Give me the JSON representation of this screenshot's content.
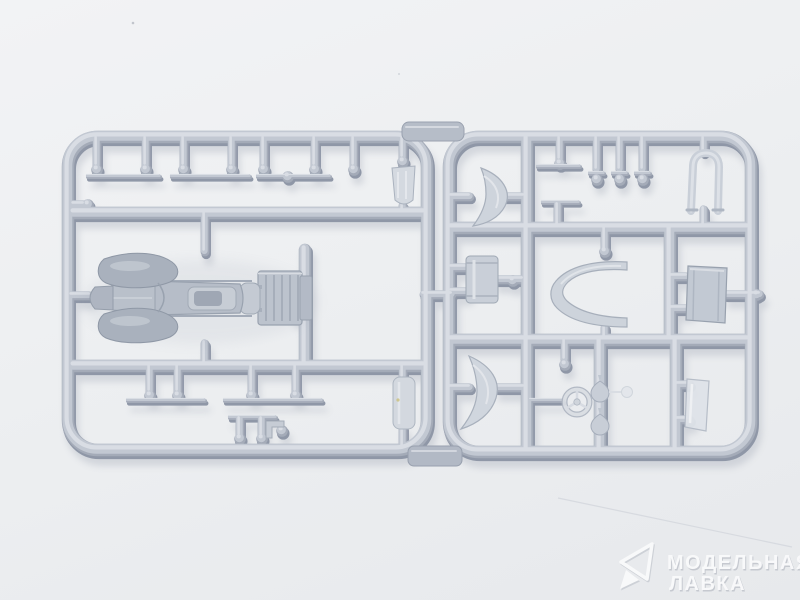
{
  "scene": {
    "subject": "grey injection-molded model kit sprue with vintage car parts on white surface",
    "background_color": "#eceef1",
    "plastic_color": "#a4abb8",
    "plastic_highlight": "#dbdfe6",
    "plastic_shadow": "#8e96a6",
    "part_names": [
      "car-body",
      "front-fender-crescent",
      "rear-fender-crescent",
      "radiator-shell",
      "windshield-frame",
      "boat-tail-shell",
      "fuel-tank-box",
      "cargo-box",
      "steering-wheel",
      "headlight-domes",
      "window-glass-panel",
      "muffler",
      "axle-strips",
      "sprue-pins"
    ]
  },
  "watermark": {
    "line1": "МОДЕЛЬНАЯ",
    "line2": "ЛАВКА",
    "logo": "paper-plane-icon",
    "color": "#ffffff",
    "opacity": "0.72"
  }
}
